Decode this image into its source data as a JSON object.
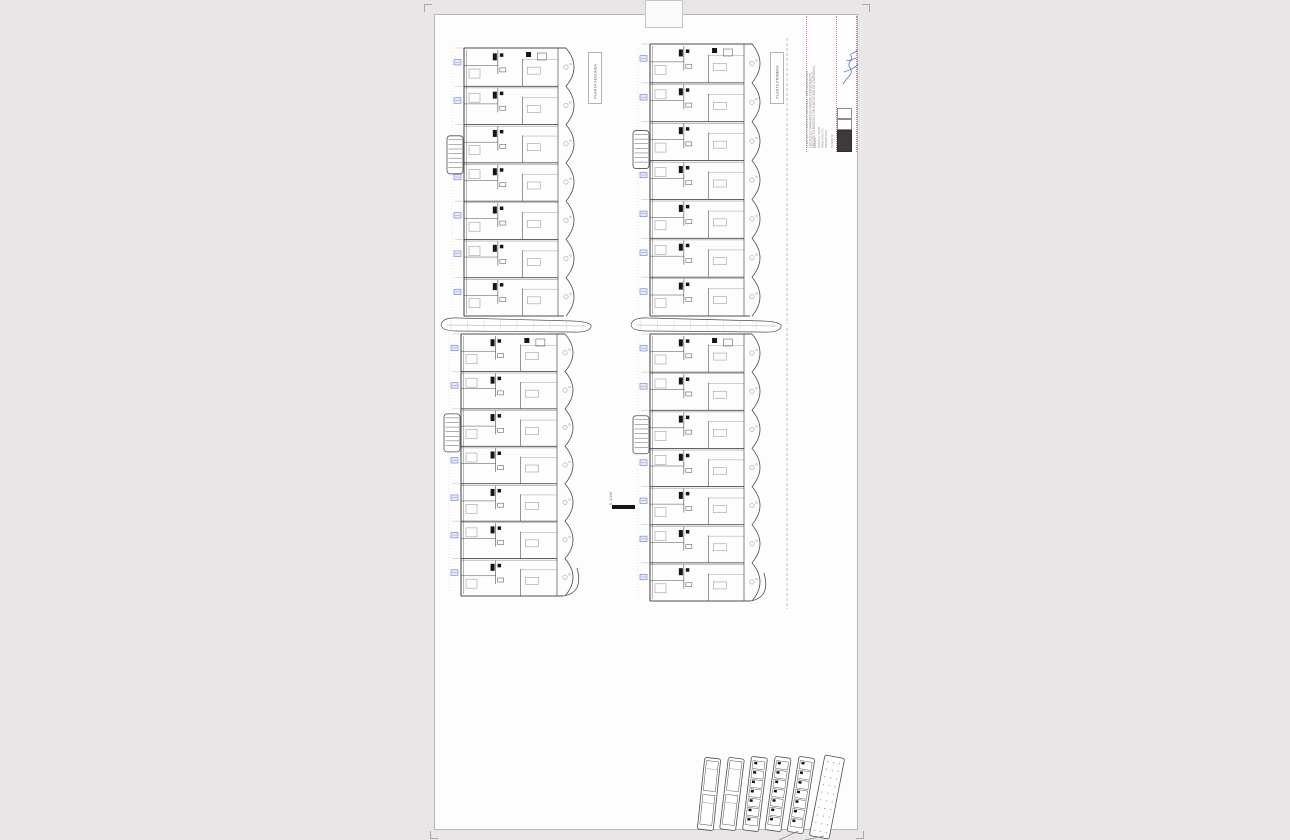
{
  "page": {
    "background": "#e8e6e6",
    "sheet_color": "#fdfdfd"
  },
  "colors": {
    "line": "#4d4d4d",
    "faint": "#8f8c8c",
    "black": "#151515",
    "blue": "#6b79c8",
    "blue_fill": "#e9ecf8",
    "pink": "#cf7ba2",
    "signature_blue": "#4466bb",
    "logo_dark": "#3c3a3a"
  },
  "plan_labels": [
    {
      "id": "label-segunda",
      "text": "PLANTA SEGUNDA"
    },
    {
      "id": "label-primera",
      "text": "PLANTA PRIMERA"
    }
  ],
  "title_block": {
    "columns": [
      {
        "x": 9,
        "font": 3.2,
        "lines": [
          "PROYECTO BASICO Y DE EJECUCION DE VIVIENDAS,",
          "LOCALES Y GARAJES EN PARCELA RESIDENCIAL",
          "PLANTAS PRIMERA Y SEGUNDA - INSTALACIONES"
        ]
      },
      {
        "x": 21,
        "font": 3.0,
        "lines": [
          "PROMOTOR:",
          "ARQUITECTO:",
          "ESCALA: 1/100",
          "FECHA:"
        ]
      },
      {
        "x": 27,
        "font": 3.0,
        "lines": [
          "PLANO N:"
        ]
      }
    ],
    "signature_name": "signature-scribble",
    "logo_name": "studio-logo"
  },
  "scale_bar": {
    "label": "E: 1/100"
  },
  "plans": [
    {
      "id": "plan-tl",
      "name": "floor-plan-top-left",
      "units": 7,
      "stairFrac": 0.4,
      "boundary": false,
      "endCurve": false
    },
    {
      "id": "plan-tr",
      "name": "floor-plan-top-right",
      "units": 7,
      "stairFrac": 0.39,
      "boundary": true,
      "endCurve": false
    },
    {
      "id": "plan-bl",
      "name": "floor-plan-bottom-left",
      "units": 7,
      "stairFrac": 0.38,
      "boundary": false,
      "endCurve": true
    },
    {
      "id": "plan-br",
      "name": "floor-plan-bottom-right",
      "units": 7,
      "stairFrac": 0.38,
      "boundary": true,
      "endCurve": true
    }
  ],
  "strips": [
    {
      "id": "strip-left"
    },
    {
      "id": "strip-right"
    }
  ],
  "key_plans": {
    "items": [
      {
        "cx": 21,
        "cy": 46,
        "w": 16,
        "h": 72,
        "rot": 6,
        "style": "big-cells"
      },
      {
        "cx": 44,
        "cy": 46,
        "w": 16,
        "h": 72,
        "rot": 7,
        "style": "big-cells"
      },
      {
        "cx": 67,
        "cy": 46,
        "w": 16,
        "h": 74,
        "rot": 7,
        "style": "small-cells"
      },
      {
        "cx": 90,
        "cy": 46,
        "w": 16,
        "h": 74,
        "rot": 8,
        "style": "small-cells"
      },
      {
        "cx": 113,
        "cy": 47,
        "w": 16,
        "h": 76,
        "rot": 9,
        "style": "small-cells",
        "leader": true
      },
      {
        "cx": 139,
        "cy": 49,
        "w": 20,
        "h": 82,
        "rot": 11,
        "style": "dots",
        "leader": true
      }
    ]
  }
}
